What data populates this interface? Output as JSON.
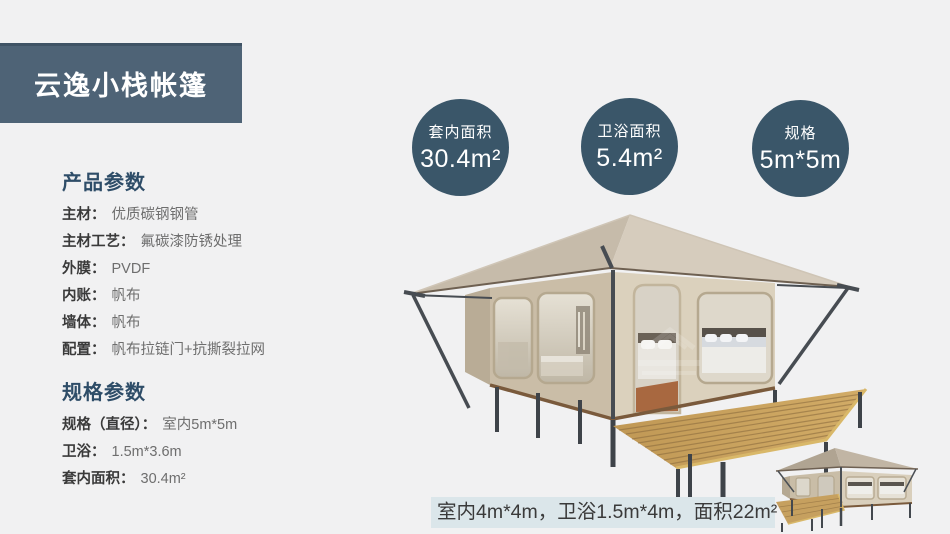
{
  "banner": {
    "title": "云逸小栈帐篷"
  },
  "stat_circles": [
    {
      "label": "套内面积",
      "value": "30.4m²"
    },
    {
      "label": "卫浴面积",
      "value": "5.4m²"
    },
    {
      "label": "规格",
      "value": "5m*5m"
    }
  ],
  "product_params": {
    "heading": "产品参数",
    "items": [
      {
        "label": "主材：",
        "value": "优质碳钢钢管"
      },
      {
        "label": "主材工艺：",
        "value": "氟碳漆防锈处理"
      },
      {
        "label": "外膜：",
        "value": "PVDF"
      },
      {
        "label": "内账：",
        "value": "帆布"
      },
      {
        "label": "墙体：",
        "value": "帆布"
      },
      {
        "label": "配置：",
        "value": "帆布拉链门+抗撕裂拉网"
      }
    ]
  },
  "spec_params": {
    "heading": "规格参数",
    "items": [
      {
        "label": "规格（直径）：",
        "value": "室内5m*5m"
      },
      {
        "label": "卫浴：",
        "value": "1.5m*3.6m"
      },
      {
        "label": "套内面积：",
        "value": "30.4m²"
      }
    ]
  },
  "footnote": {
    "text": "室内4m*4m，卫浴1.5m*4m，面积22m²"
  },
  "colors": {
    "page_bg": "#f1f1f2",
    "banner_bg": "#4e6376",
    "circle_bg": "#3a5669",
    "heading_text": "#2e4d68",
    "footnote_bg": "#dbe6ea",
    "tent_canvas": "#d6ccbd",
    "deck_wood": "#c6a05f",
    "steel_frame": "#474c52"
  }
}
